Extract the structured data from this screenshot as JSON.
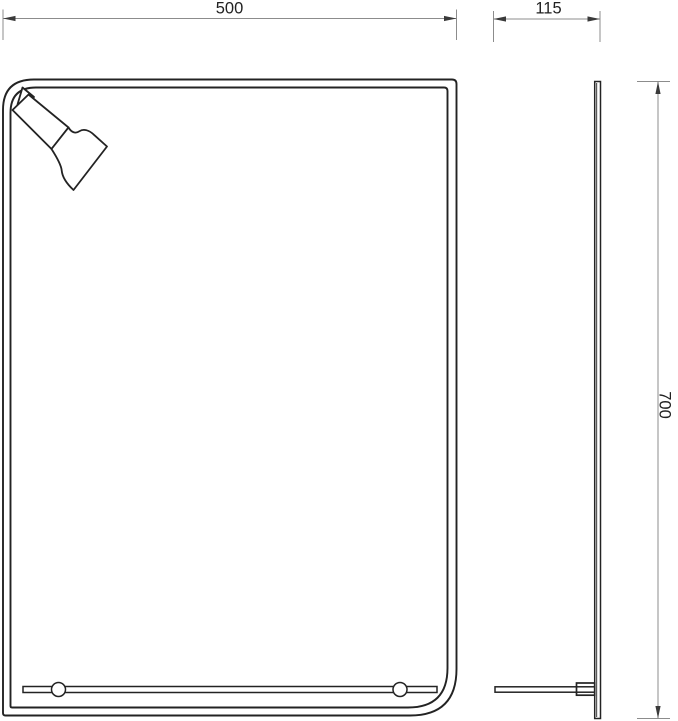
{
  "drawing": {
    "dimensions": {
      "width": {
        "label": "500",
        "value": 500
      },
      "depth": {
        "label": "115",
        "value": 115
      },
      "height": {
        "label": "700",
        "value": 700
      }
    },
    "icons": {
      "lamp": "spotlight-lamp-icon",
      "dimension_arrow": "dimension-arrow-icon"
    },
    "colors": {
      "background": "#ffffff",
      "object_line": "#232323",
      "dimension_line": "#8c8c8c",
      "arrow_fill": "#3a3a3a",
      "text": "#222222"
    }
  }
}
